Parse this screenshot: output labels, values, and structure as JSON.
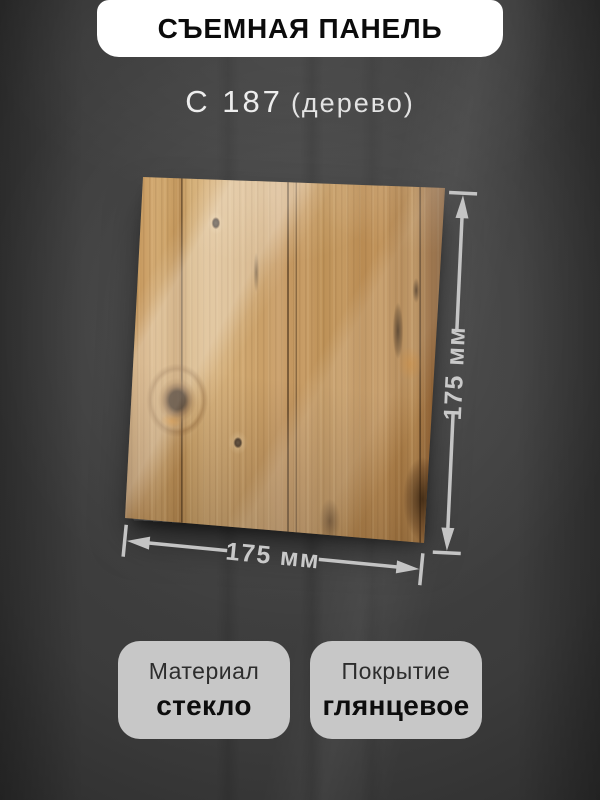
{
  "header": {
    "title": "СЪЕМНАЯ ПАНЕЛЬ",
    "code": "C 187",
    "code_note": "(дерево)"
  },
  "dimensions": {
    "height_label": "175 мм",
    "width_label": "175 мм"
  },
  "specs": [
    {
      "label": "Материал",
      "value": "стекло"
    },
    {
      "label": "Покрытие",
      "value": "глянцевое"
    }
  ],
  "colors": {
    "background": "#3a3a3a",
    "banner": "#ffffff",
    "card": "#c7c7c7",
    "dimension_lines": "#c4c4c4",
    "wood_base": "#c89e66",
    "text_dark": "#0d0d0d",
    "text_light": "#ededed"
  }
}
